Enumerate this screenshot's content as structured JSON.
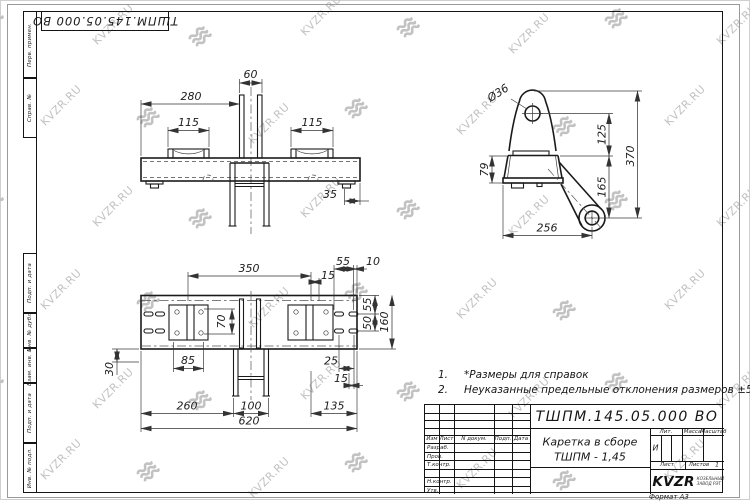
{
  "watermark": {
    "text": "KVZR.RU",
    "color": "#c2c2c2"
  },
  "stamp_top": "ТШПМ.145.05.000  ВО",
  "margin_labels": {
    "perv": "Перв. примен.",
    "sprav": "Справ. №",
    "podp1": "Подп. и дата",
    "inv_dubl": "Инв. № дубл.",
    "vzam": "Взам. инв. №",
    "podp2": "Подп. и дата",
    "inv_podl": "Инв. № подл."
  },
  "views": {
    "front": {
      "dims": {
        "d60": "60",
        "d280": "280",
        "d115l": "115",
        "d115r": "115",
        "d35": "35"
      }
    },
    "side": {
      "dims": {
        "dia36": "Ø36",
        "d125": "125",
        "d370": "370",
        "d165": "165",
        "d79": "79",
        "d256": "256"
      }
    },
    "plan": {
      "dims": {
        "d350": "350",
        "d15t": "15",
        "d55t": "55",
        "d10": "10",
        "d55r": "55",
        "d50": "50",
        "d160": "160",
        "d70": "70",
        "d85": "85",
        "d30": "30",
        "d25": "25",
        "d15r": "15",
        "d260": "260",
        "d100": "100",
        "d135": "135",
        "d620": "620"
      }
    }
  },
  "notes": {
    "n1_num": "1.",
    "n1_text": "*Размеры для справок",
    "n2_num": "2.",
    "n2_text": "Неуказанные предельные отклонения размеров  ±5 мм."
  },
  "title_block": {
    "designation": "ТШПМ.145.05.000  ВО",
    "name_line1": "Каретка в сборе",
    "name_line2": "ТШПМ - 1,45",
    "header": {
      "izm": "Изм",
      "list": "Лист",
      "doc": "N докум.",
      "podp": "Подп.",
      "data": "Дата"
    },
    "rows": {
      "razrab": "Разраб.",
      "prov": "Пров.",
      "tkontr": "Т.контр.",
      "nkontr": "Н.контр.",
      "utv": "Утв."
    },
    "lit_header": "Лит.",
    "mass_header": "Масса",
    "scale_header": "Масштаб",
    "lit_value": "И",
    "sheet_label": "Лист",
    "sheets_label": "Листов",
    "sheets_value": "1",
    "company_name": "KVZR",
    "company_sub1": "КОЗЕЛЬНЫЙ",
    "company_sub2": "ЗАВОД РЭТ",
    "format": "Формат А3"
  }
}
